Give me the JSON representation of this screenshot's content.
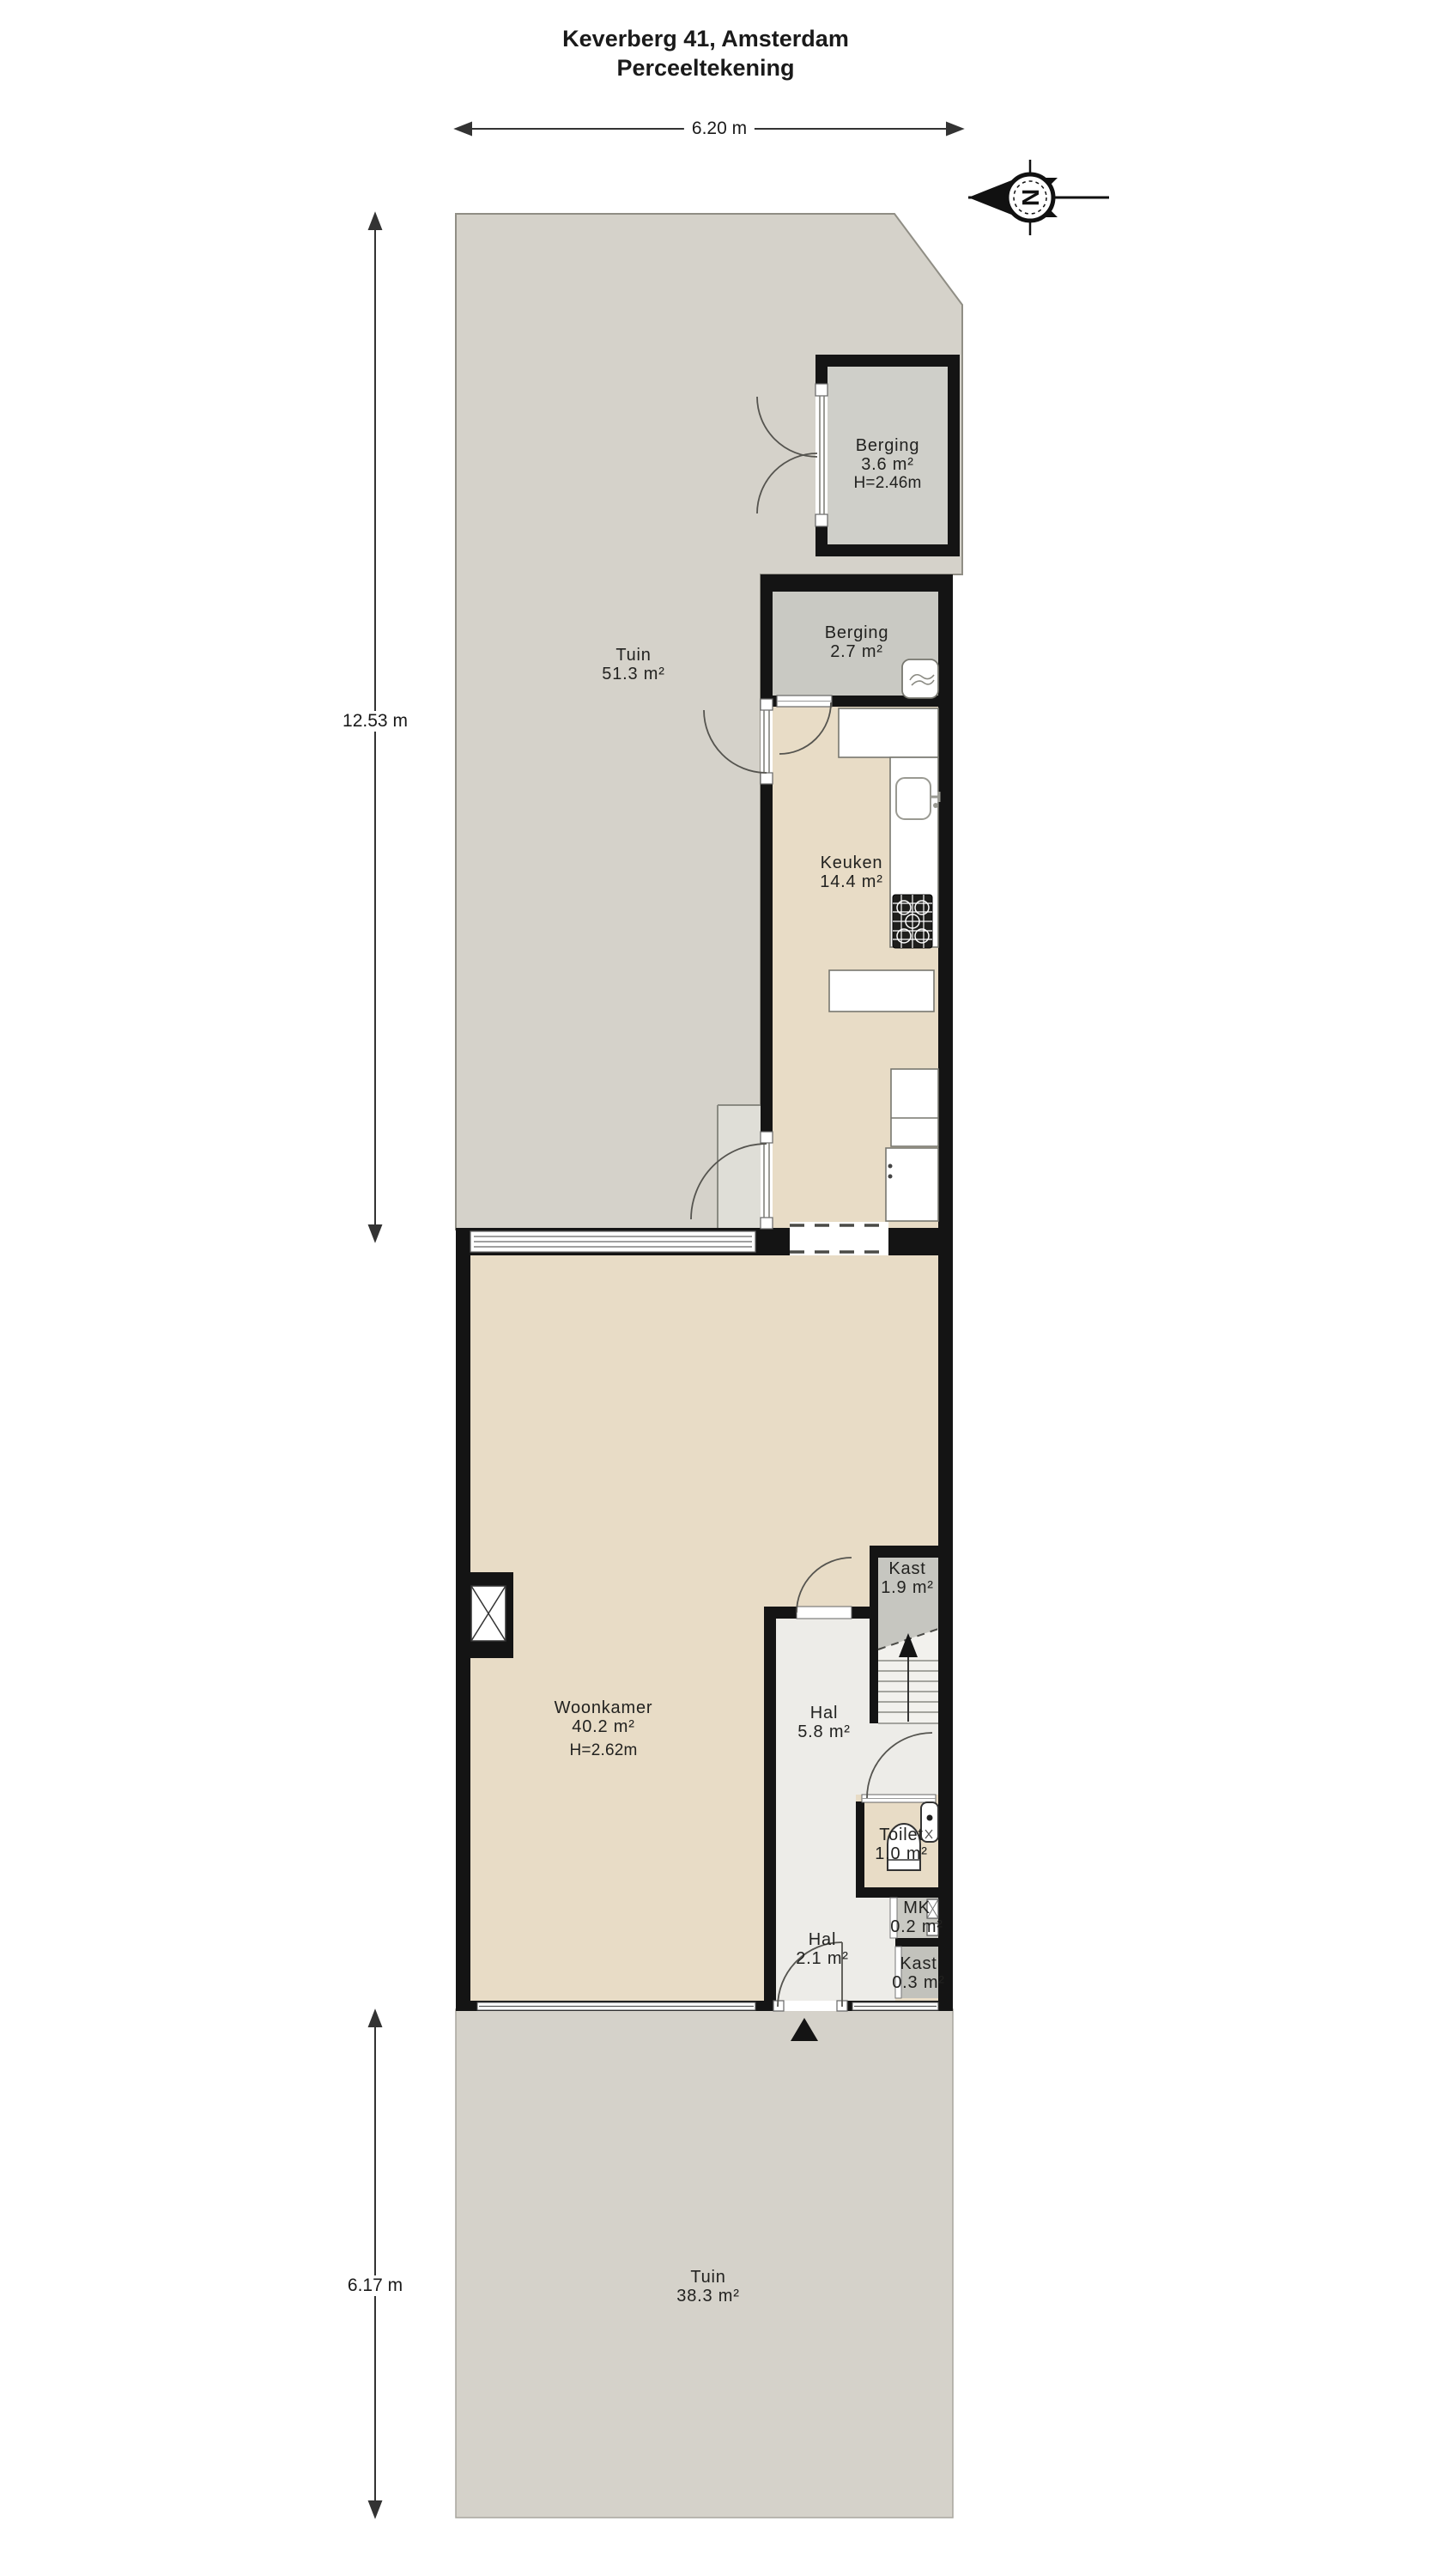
{
  "title": {
    "line1": "Keverberg 41, Amsterdam",
    "line2": "Perceeltekening"
  },
  "dimensions": {
    "top_width": "6.20 m",
    "left_upper": "12.53 m",
    "left_lower": "6.17 m"
  },
  "compass": {
    "letter": "N"
  },
  "rooms": [
    {
      "id": "tuin-top",
      "name": "Tuin",
      "area": "51.3 m²"
    },
    {
      "id": "berging-top",
      "name": "Berging",
      "area": "3.6 m²",
      "height": "H=2.46m"
    },
    {
      "id": "berging",
      "name": "Berging",
      "area": "2.7 m²"
    },
    {
      "id": "keuken",
      "name": "Keuken",
      "area": "14.4 m²"
    },
    {
      "id": "woonkamer",
      "name": "Woonkamer",
      "area": "40.2 m²",
      "height": "H=2.62m"
    },
    {
      "id": "kast-boven",
      "name": "Kast",
      "area": "1.9 m²"
    },
    {
      "id": "hal",
      "name": "Hal",
      "area": "5.8 m²"
    },
    {
      "id": "toilet",
      "name": "Toilet",
      "area": "1.0 m²"
    },
    {
      "id": "mk",
      "name": "MK",
      "area": "0.2 m²"
    },
    {
      "id": "hal-entree",
      "name": "Hal",
      "area": "2.1 m²"
    },
    {
      "id": "kast-entree",
      "name": "Kast",
      "area": "0.3 m²"
    },
    {
      "id": "tuin-onder",
      "name": "Tuin",
      "area": "38.3 m²"
    }
  ],
  "colors": {
    "garden": "#d5d2ca",
    "shed_floor": "#cfcfc9",
    "storage_floor": "#c9c9c3",
    "living_floor": "#e8dcc6",
    "hall_floor": "#edece8",
    "closet_floor": "#c6c6c0",
    "wall": "#141414",
    "fixture_stroke": "#777770"
  }
}
